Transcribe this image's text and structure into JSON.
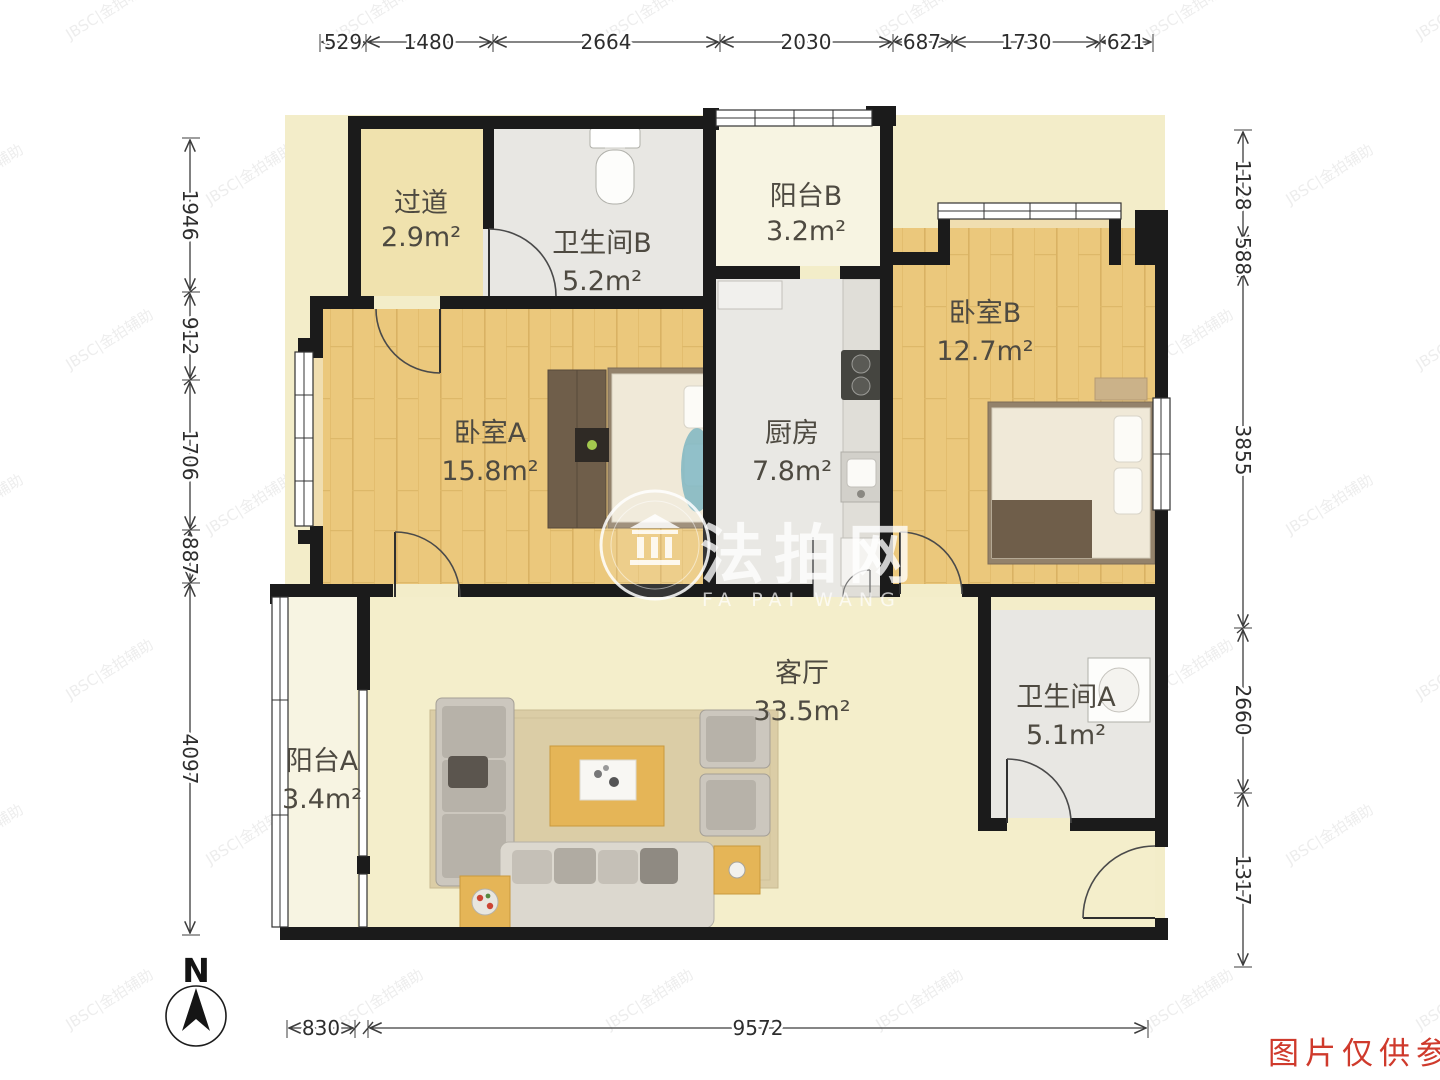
{
  "plan": {
    "rooms": [
      {
        "id": "guodao",
        "name": "过道",
        "area": "2.9m²"
      },
      {
        "id": "weishengjianB",
        "name": "卫生间B",
        "area": "5.2m²"
      },
      {
        "id": "yangtaiB",
        "name": "阳台B",
        "area": "3.2m²"
      },
      {
        "id": "woshiB",
        "name": "卧室B",
        "area": "12.7m²"
      },
      {
        "id": "woshiA",
        "name": "卧室A",
        "area": "15.8m²"
      },
      {
        "id": "chufang",
        "name": "厨房",
        "area": "7.8m²"
      },
      {
        "id": "keting",
        "name": "客厅",
        "area": "33.5m²"
      },
      {
        "id": "weishengjianA",
        "name": "卫生间A",
        "area": "5.1m²"
      },
      {
        "id": "yangtaiA",
        "name": "阳台A",
        "area": "3.4m²"
      }
    ],
    "dimensions": {
      "top": [
        "529",
        "1480",
        "2664",
        "2030",
        "687",
        "1730",
        "621"
      ],
      "left": [
        "1946",
        "912",
        "1706",
        "887",
        "4097"
      ],
      "right": [
        "1128",
        "588",
        "3855",
        "2660",
        "1317"
      ],
      "bottom": [
        "830",
        "9572"
      ]
    },
    "compass_label": "N"
  },
  "watermark": {
    "brand": "法拍网",
    "brand_sub": "FA PAI WANG",
    "tile": "JBSC|金拍辅助"
  },
  "footer": {
    "disclaimer": "图片仅供参考"
  },
  "colors": {
    "wall": "#1b1b1b",
    "wood_floor": "#ebc87c",
    "hall_floor": "#f0e2ae",
    "tile_floor": "#e8e7e3",
    "balcony_floor": "#f7f4e2",
    "living_floor": "#f4eecb",
    "accent_red": "#cf3a2c"
  }
}
